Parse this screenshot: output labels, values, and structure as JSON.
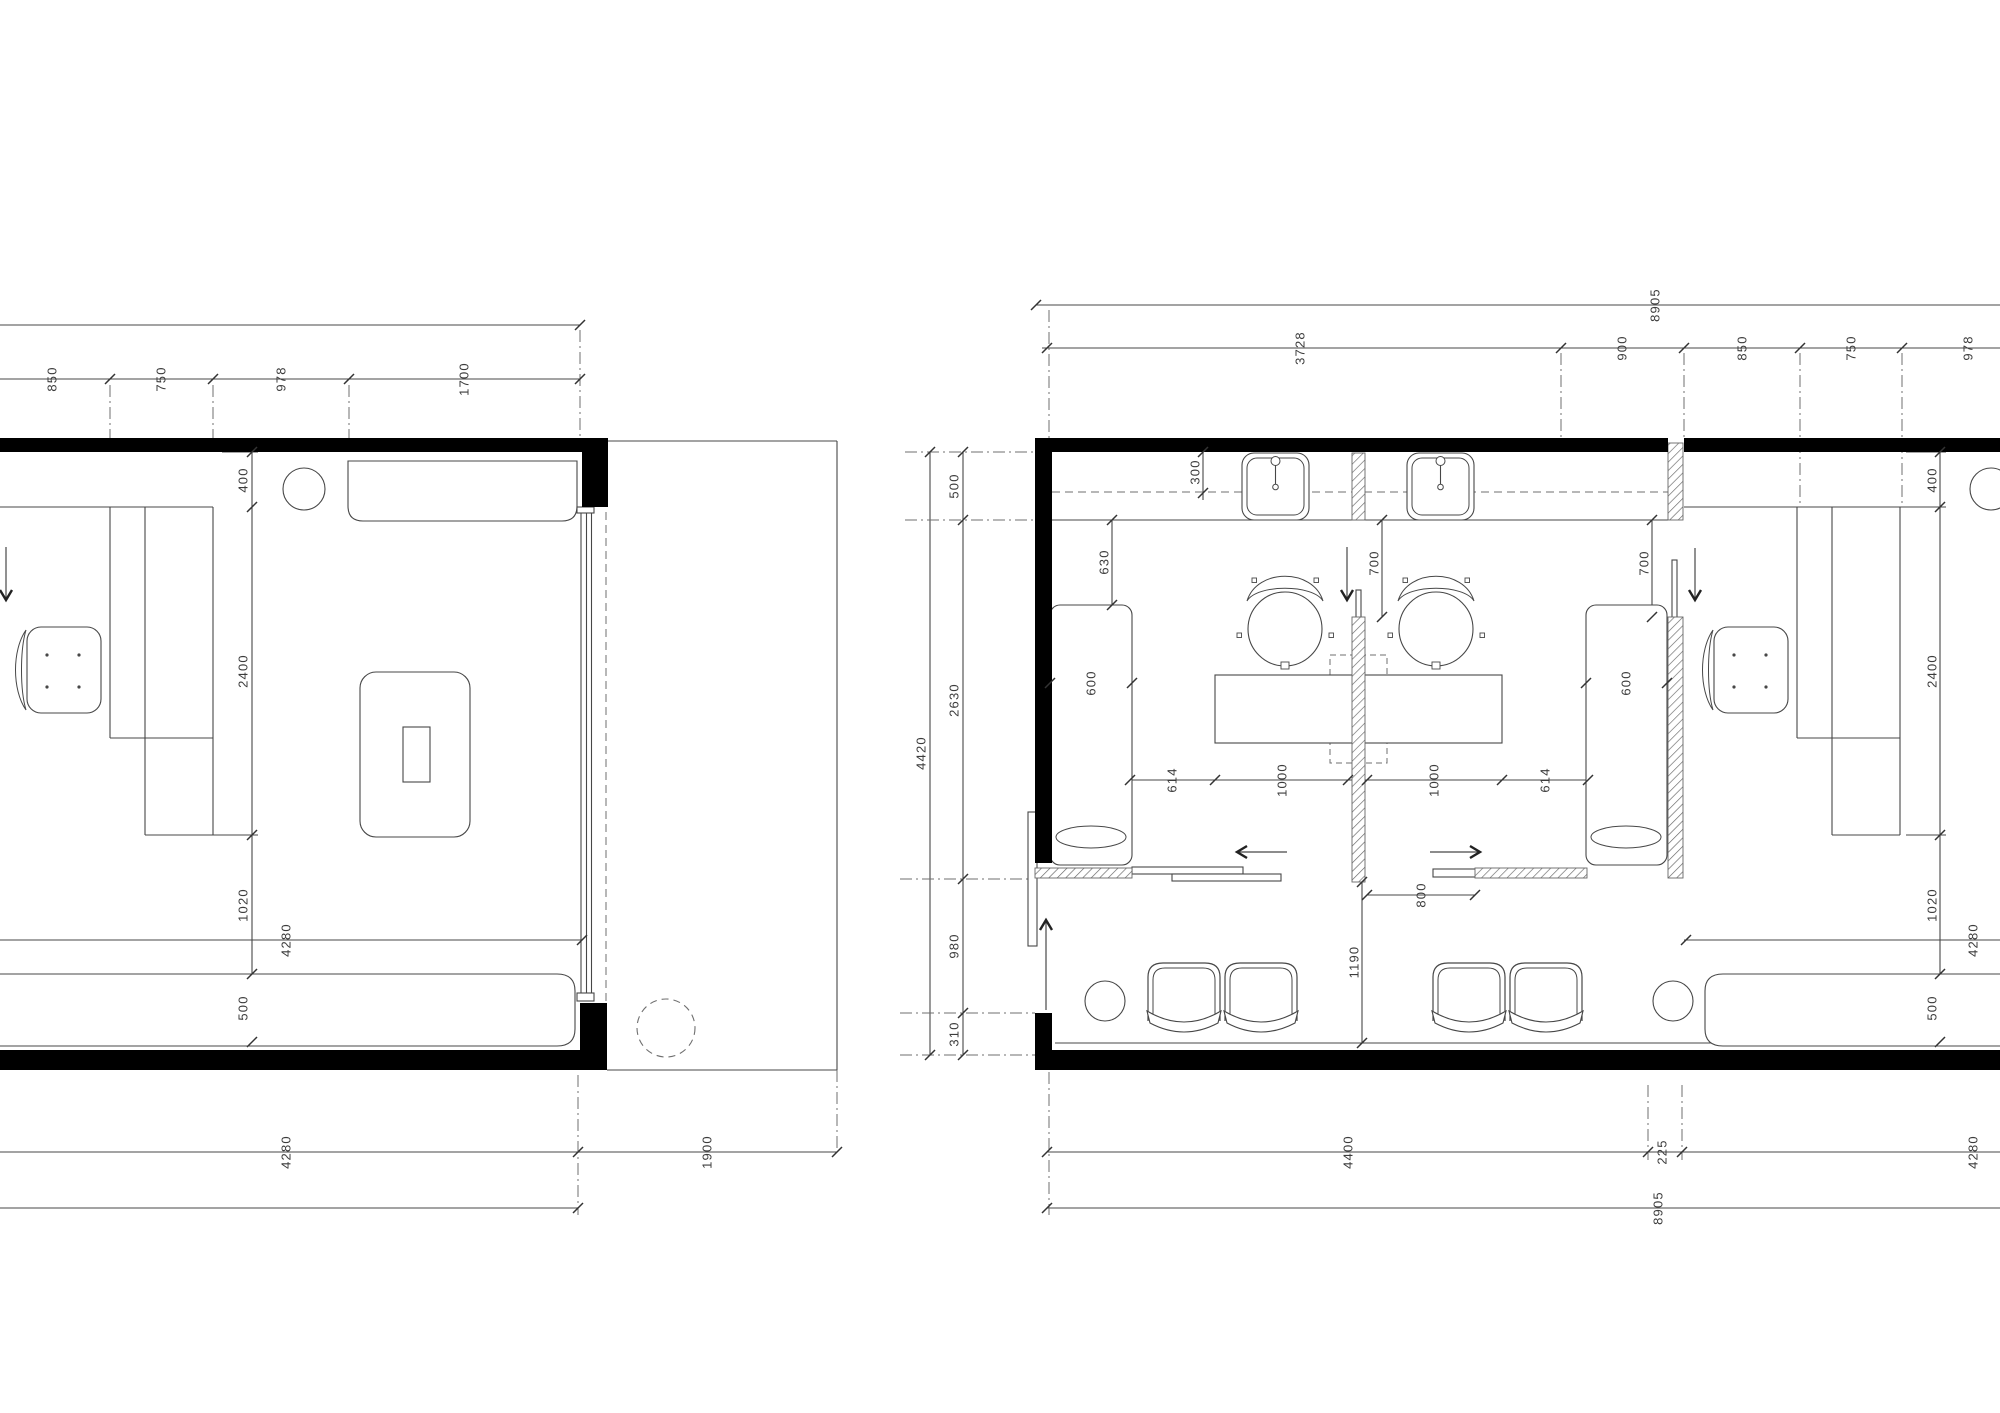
{
  "meta": {
    "title": "floor-plan-drawing",
    "canvas": {
      "w": 2000,
      "h": 1413,
      "bg": "#ffffff"
    },
    "colors": {
      "line": "#474747",
      "dim": "#6f6f6f",
      "wall": "#000000",
      "hatch": "#666666",
      "text": "#3c3c3c"
    }
  },
  "left_plan": {
    "top_dims": [
      "850",
      "750",
      "978",
      "1700"
    ],
    "side_dims": [
      "400",
      "2400",
      "1020",
      "500"
    ],
    "room_width": "4280",
    "terrace_width": "1900",
    "bottom_dims": [
      "4280",
      "1900"
    ]
  },
  "right_plan": {
    "overall_dim": "8905",
    "top_dims": [
      "3728",
      "900",
      "850",
      "750",
      "978"
    ],
    "left_side_dims": [
      "500",
      "2630",
      "980",
      "310"
    ],
    "left_overall": "4420",
    "interior_dims": [
      "300",
      "630",
      "600",
      "700",
      "700",
      "600",
      "614",
      "1000",
      "1000",
      "614",
      "800",
      "1190"
    ],
    "right_side_dims": [
      "400",
      "2400",
      "1020",
      "500"
    ],
    "room_width": "4280",
    "bottom_dims": [
      "4400",
      "225",
      "4280"
    ],
    "bottom_overall": "8905"
  },
  "prim": {
    "walls": [
      [
        0,
        438,
        582,
        14
      ],
      [
        582,
        438,
        26,
        69
      ],
      [
        0,
        1050,
        580,
        20
      ],
      [
        580,
        1003,
        27,
        67
      ],
      [
        1035,
        438,
        633,
        14
      ],
      [
        1684,
        438,
        316,
        14
      ],
      [
        1035,
        438,
        17,
        425
      ],
      [
        1035,
        1013,
        17,
        57
      ],
      [
        1050,
        1050,
        950,
        20
      ]
    ],
    "hatches": [
      [
        1352,
        453,
        13,
        67
      ],
      [
        1352,
        617,
        13,
        265
      ],
      [
        1668,
        443,
        15,
        77
      ],
      [
        1668,
        617,
        15,
        261
      ],
      [
        1035,
        868,
        97,
        10
      ],
      [
        1475,
        868,
        112,
        10
      ]
    ],
    "lines": [
      [
        0,
        325,
        580,
        325
      ],
      [
        0,
        379,
        580,
        379
      ],
      [
        252,
        452,
        252,
        1042
      ],
      [
        0,
        940,
        582,
        940
      ],
      [
        0,
        1152,
        837,
        1152
      ],
      [
        0,
        1208,
        578,
        1208
      ],
      [
        0,
        507,
        213,
        507
      ],
      [
        110,
        507,
        110,
        738
      ],
      [
        145,
        507,
        145,
        835
      ],
      [
        213,
        507,
        213,
        835
      ],
      [
        110,
        738,
        213,
        738
      ],
      [
        145,
        835,
        213,
        835
      ],
      [
        348,
        469,
        577,
        469
      ],
      [
        608,
        441,
        837,
        441
      ],
      [
        837,
        441,
        837,
        1070
      ],
      [
        607,
        1070,
        837,
        1070
      ],
      [
        222,
        452,
        258,
        452
      ],
      [
        213,
        835,
        258,
        835
      ],
      [
        222,
        1042,
        258,
        1042
      ],
      [
        1036,
        305,
        2000,
        305
      ],
      [
        1042,
        348,
        2000,
        348
      ],
      [
        930,
        452,
        930,
        1055
      ],
      [
        963,
        452,
        963,
        1055
      ],
      [
        1203,
        445,
        1203,
        500
      ],
      [
        1052,
        520,
        1668,
        520
      ],
      [
        1112,
        520,
        1112,
        605
      ],
      [
        1050,
        683,
        1132,
        683
      ],
      [
        1586,
        683,
        1667,
        683
      ],
      [
        1382,
        520,
        1382,
        617
      ],
      [
        1652,
        520,
        1652,
        617
      ],
      [
        1130,
        780,
        1588,
        780
      ],
      [
        1367,
        895,
        1475,
        895
      ],
      [
        1362,
        882,
        1362,
        1043
      ],
      [
        1055,
        1043,
        2000,
        1043
      ],
      [
        1047,
        1152,
        2000,
        1152
      ],
      [
        1047,
        1208,
        2000,
        1208
      ],
      [
        1684,
        507,
        1900,
        507
      ],
      [
        1797,
        507,
        1797,
        738
      ],
      [
        1832,
        507,
        1832,
        835
      ],
      [
        1900,
        507,
        1900,
        835
      ],
      [
        1797,
        738,
        1900,
        738
      ],
      [
        1832,
        835,
        1900,
        835
      ],
      [
        1684,
        940,
        2000,
        940
      ],
      [
        1940,
        452,
        1940,
        1042
      ],
      [
        1906,
        452,
        1946,
        452
      ],
      [
        1900,
        507,
        1946,
        507
      ],
      [
        1906,
        835,
        1946,
        835
      ],
      [
        1910,
        1042,
        1946,
        1042
      ]
    ],
    "overlay_lines": [
      [
        581,
        513,
        581,
        993
      ],
      [
        586.5,
        513,
        586.5,
        993
      ],
      [
        591.5,
        513,
        591.5,
        993
      ],
      [
        1275.5,
        465,
        1275.5,
        484
      ],
      [
        1440.5,
        465,
        1440.5,
        484
      ]
    ],
    "dashdot": [
      [
        110,
        385,
        110,
        438
      ],
      [
        213,
        385,
        213,
        438
      ],
      [
        349,
        385,
        349,
        438
      ],
      [
        580,
        330,
        580,
        438
      ],
      [
        578,
        1075,
        578,
        1215
      ],
      [
        837,
        1070,
        837,
        1152
      ],
      [
        1049,
        310,
        1049,
        438
      ],
      [
        1561,
        353,
        1561,
        441
      ],
      [
        1684,
        353,
        1684,
        441
      ],
      [
        1800,
        353,
        1800,
        503
      ],
      [
        1902,
        353,
        1902,
        503
      ],
      [
        905,
        452,
        1035,
        452
      ],
      [
        905,
        520,
        1035,
        520
      ],
      [
        900,
        879,
        1035,
        879
      ],
      [
        900,
        1013,
        1035,
        1013
      ],
      [
        900,
        1055,
        1048,
        1055
      ],
      [
        1049,
        1072,
        1049,
        1215
      ],
      [
        1648,
        1085,
        1648,
        1160
      ],
      [
        1682,
        1085,
        1682,
        1160
      ]
    ],
    "dashed_lines": [
      [
        606,
        512,
        606,
        1003
      ],
      [
        1052,
        492,
        1668,
        492
      ]
    ],
    "dashed_rects": [
      [
        1330,
        655,
        57,
        108
      ]
    ],
    "dashed_circles": [
      [
        666,
        1028,
        29
      ]
    ],
    "rects": [
      [
        403,
        727,
        27,
        55
      ],
      [
        577,
        507,
        17,
        6
      ],
      [
        577,
        993,
        17,
        8
      ],
      [
        1132,
        867,
        111,
        7
      ],
      [
        1172,
        874,
        109,
        7
      ],
      [
        1433,
        869,
        110,
        8
      ],
      [
        1028,
        812,
        9,
        134
      ],
      [
        1356,
        590,
        5,
        123
      ],
      [
        1672,
        560,
        5,
        123
      ],
      [
        1215,
        675,
        287,
        68
      ]
    ],
    "roundrects": [
      [
        360,
        672,
        110,
        165,
        16
      ],
      [
        1050,
        605,
        82,
        260,
        10
      ],
      [
        1586,
        605,
        81,
        260,
        10
      ]
    ],
    "circles": [
      [
        304,
        489,
        21
      ],
      [
        1991,
        489,
        21
      ],
      [
        1105,
        1001,
        20
      ],
      [
        1673,
        1001,
        20
      ]
    ],
    "ellipses": [
      [
        1091,
        837,
        35,
        11
      ],
      [
        1626,
        837,
        35,
        11
      ]
    ],
    "paths": [
      {
        "d": "M348,461 H577 V506 Q577,521 562,521 H363 Q348,521 348,506 Z",
        "n": "wall-shelf"
      },
      {
        "d": "M-10,974 H557 Q575,974 575,991 V1029 Q575,1046 557,1046 H-10 Z",
        "n": "sofa-left-plan"
      },
      {
        "d": "M2005,974 H1723 Q1705,974 1705,991 V1029 Q1705,1046 1723,1046 H2005 Z",
        "n": "sofa-right-room"
      }
    ],
    "sinks": [
      1275.5,
      1440.5
    ],
    "ochairs": [
      {
        "sx": 27,
        "sy": 627
      },
      {
        "sx": 1714,
        "sy": 627
      }
    ],
    "schairs": [
      {
        "cx": 1285,
        "cy": 629
      },
      {
        "cx": 1436,
        "cy": 629
      }
    ],
    "wchairs": [
      {
        "x": 1148,
        "y": 963
      },
      {
        "x": 1225,
        "y": 963
      },
      {
        "x": 1433,
        "y": 963
      },
      {
        "x": 1510,
        "y": 963
      }
    ],
    "ticks": [
      [
        110,
        379
      ],
      [
        213,
        379
      ],
      [
        349,
        379
      ],
      [
        580,
        379
      ],
      [
        580,
        325
      ],
      [
        252,
        452
      ],
      [
        252,
        507
      ],
      [
        252,
        835
      ],
      [
        252,
        974
      ],
      [
        252,
        1042
      ],
      [
        582,
        940
      ],
      [
        578,
        1152
      ],
      [
        837,
        1152
      ],
      [
        578,
        1208
      ],
      [
        1036,
        305
      ],
      [
        1047,
        348
      ],
      [
        1561,
        348
      ],
      [
        1684,
        348
      ],
      [
        1800,
        348
      ],
      [
        1902,
        348
      ],
      [
        930,
        452
      ],
      [
        930,
        1055
      ],
      [
        963,
        452
      ],
      [
        963,
        520
      ],
      [
        963,
        879
      ],
      [
        963,
        1013
      ],
      [
        963,
        1055
      ],
      [
        1203,
        452
      ],
      [
        1203,
        493
      ],
      [
        1112,
        520
      ],
      [
        1112,
        605
      ],
      [
        1050,
        683
      ],
      [
        1132,
        683
      ],
      [
        1586,
        683
      ],
      [
        1667,
        683
      ],
      [
        1382,
        520
      ],
      [
        1382,
        617
      ],
      [
        1652,
        520
      ],
      [
        1652,
        617
      ],
      [
        1130,
        780
      ],
      [
        1215,
        780
      ],
      [
        1348,
        780
      ],
      [
        1367,
        780
      ],
      [
        1502,
        780
      ],
      [
        1588,
        780
      ],
      [
        1367,
        895
      ],
      [
        1475,
        895
      ],
      [
        1362,
        882
      ],
      [
        1362,
        1043
      ],
      [
        1940,
        452
      ],
      [
        1940,
        507
      ],
      [
        1940,
        835
      ],
      [
        1940,
        974
      ],
      [
        1940,
        1042
      ],
      [
        1686,
        940
      ],
      [
        1047,
        1152
      ],
      [
        1648,
        1152
      ],
      [
        1682,
        1152
      ],
      [
        1047,
        1208
      ]
    ],
    "arrows": [
      [
        6,
        547,
        6,
        600
      ],
      [
        1347,
        547,
        1347,
        600
      ],
      [
        1695,
        548,
        1695,
        600
      ],
      [
        1287,
        852,
        1237,
        852
      ],
      [
        1430,
        852,
        1480,
        852
      ],
      [
        1046,
        1010,
        1046,
        920
      ]
    ],
    "labels": [
      {
        "x": 52,
        "y": 379,
        "t": "850"
      },
      {
        "x": 161,
        "y": 379,
        "t": "750"
      },
      {
        "x": 281,
        "y": 379,
        "t": "978"
      },
      {
        "x": 464,
        "y": 379,
        "t": "1700"
      },
      {
        "x": 243,
        "y": 480,
        "t": "400"
      },
      {
        "x": 243,
        "y": 671,
        "t": "2400"
      },
      {
        "x": 243,
        "y": 905,
        "t": "1020"
      },
      {
        "x": 243,
        "y": 1008,
        "t": "500"
      },
      {
        "x": 286,
        "y": 940,
        "t": "4280"
      },
      {
        "x": 286,
        "y": 1152,
        "t": "4280"
      },
      {
        "x": 707,
        "y": 1152,
        "t": "1900"
      },
      {
        "x": 1655,
        "y": 305,
        "t": "8905"
      },
      {
        "x": 1300,
        "y": 348,
        "t": "3728"
      },
      {
        "x": 1622,
        "y": 348,
        "t": "900"
      },
      {
        "x": 1742,
        "y": 348,
        "t": "850"
      },
      {
        "x": 1851,
        "y": 348,
        "t": "750"
      },
      {
        "x": 1968,
        "y": 348,
        "t": "978"
      },
      {
        "x": 954,
        "y": 486,
        "t": "500"
      },
      {
        "x": 954,
        "y": 700,
        "t": "2630"
      },
      {
        "x": 954,
        "y": 946,
        "t": "980"
      },
      {
        "x": 954,
        "y": 1034,
        "t": "310"
      },
      {
        "x": 921,
        "y": 753,
        "t": "4420"
      },
      {
        "x": 1195,
        "y": 472,
        "t": "300"
      },
      {
        "x": 1104,
        "y": 562,
        "t": "630"
      },
      {
        "x": 1091,
        "y": 683,
        "t": "600"
      },
      {
        "x": 1626,
        "y": 683,
        "t": "600"
      },
      {
        "x": 1374,
        "y": 563,
        "t": "700"
      },
      {
        "x": 1644,
        "y": 563,
        "t": "700"
      },
      {
        "x": 1172,
        "y": 780,
        "t": "614"
      },
      {
        "x": 1282,
        "y": 780,
        "t": "1000"
      },
      {
        "x": 1434,
        "y": 780,
        "t": "1000"
      },
      {
        "x": 1545,
        "y": 780,
        "t": "614"
      },
      {
        "x": 1421,
        "y": 895,
        "t": "800"
      },
      {
        "x": 1354,
        "y": 962,
        "t": "1190"
      },
      {
        "x": 1932,
        "y": 480,
        "t": "400"
      },
      {
        "x": 1932,
        "y": 671,
        "t": "2400"
      },
      {
        "x": 1932,
        "y": 905,
        "t": "1020"
      },
      {
        "x": 1932,
        "y": 1008,
        "t": "500"
      },
      {
        "x": 1973,
        "y": 940,
        "t": "4280"
      },
      {
        "x": 1348,
        "y": 1152,
        "t": "4400"
      },
      {
        "x": 1662,
        "y": 1152,
        "t": "225"
      },
      {
        "x": 1973,
        "y": 1152,
        "t": "4280"
      },
      {
        "x": 1658,
        "y": 1208,
        "t": "8905"
      }
    ]
  }
}
